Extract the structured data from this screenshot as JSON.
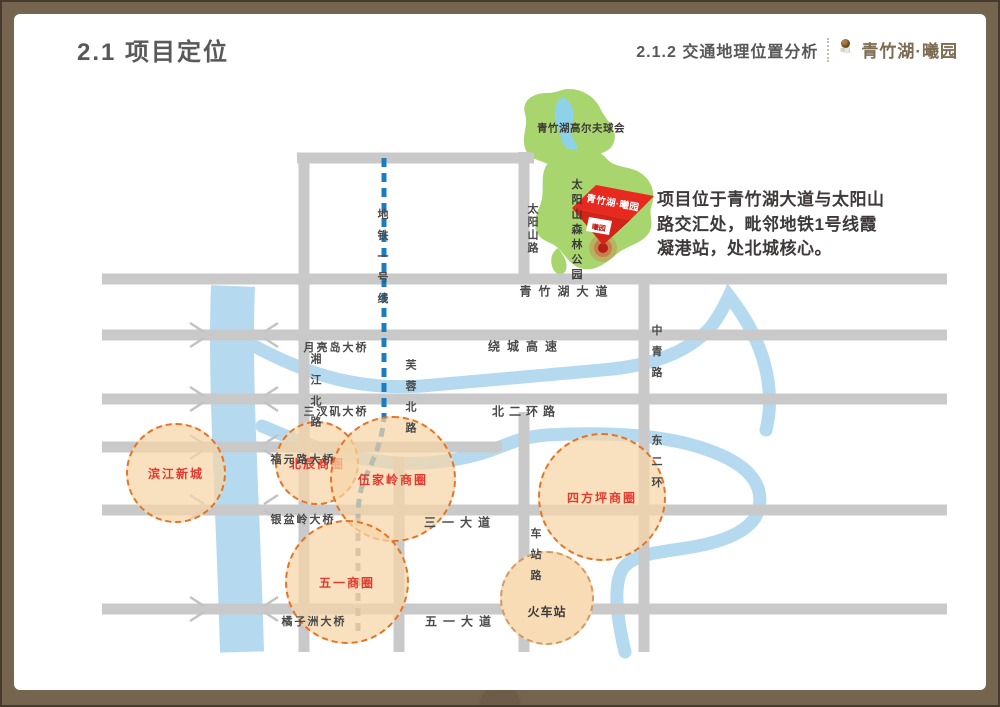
{
  "slide": {
    "title": "2.1 项目定位",
    "header": {
      "subtitle": "2.1.2 交通地理位置分析",
      "brand": "青竹湖·曦园",
      "logo_icon": "brand-emblem"
    },
    "annotation_lines": [
      "项目位于青竹湖大道与太阳山",
      "路交汇处，毗邻地铁1号线霞",
      "凝港站，处北城核心。"
    ]
  },
  "map": {
    "parks": {
      "golf_club": "青竹湖高尔夫球会",
      "forest_park": "太阳山森林公园"
    },
    "project_marker": {
      "name": "青竹湖·曦园",
      "badge": "曦园"
    },
    "road_labels": {
      "qingzhuhu_avenue": "青竹湖大道",
      "ring_expressway": "绕城高速",
      "north_2nd_ring": "北二环路",
      "sanyi_avenue": "三一大道",
      "wuyi_avenue": "五一大道"
    },
    "vertical_labels": {
      "metro_line1": "地铁一号线",
      "xiangjiang_north_rd": "湘江北路",
      "furong_north_rd": "芙蓉北路",
      "taiyangshan_rd": "太阳山路",
      "zhongqing_rd": "中青路",
      "east_2nd_ring": "东二环",
      "chezhan_rd": "车站路"
    },
    "bridges": [
      "月亮岛大桥",
      "三汊矶大桥",
      "福元路大桥",
      "银盆岭大桥",
      "橘子洲大桥"
    ],
    "business_circles": [
      "滨江新城",
      "北辰商圈",
      "伍家岭商圈",
      "四方坪商圈",
      "五一商圈"
    ],
    "railway_station": "火车站"
  },
  "colors": {
    "frame_brown": "#75644e",
    "title_gray": "#595757",
    "brand_brown": "#7d6b52",
    "road_gray": "#c9c9c9",
    "river_blue": "#b5daf0",
    "park_green": "#a8d56d",
    "lake_blue": "#8ed2ea",
    "metro_blue": "#1c7cc0",
    "metro_south_gray": "#999999",
    "circle_fill": "#f6d5a8",
    "circle_border": "#e0762a",
    "highlight_red": "#e23a2e",
    "marker_red": "#e8291f"
  }
}
